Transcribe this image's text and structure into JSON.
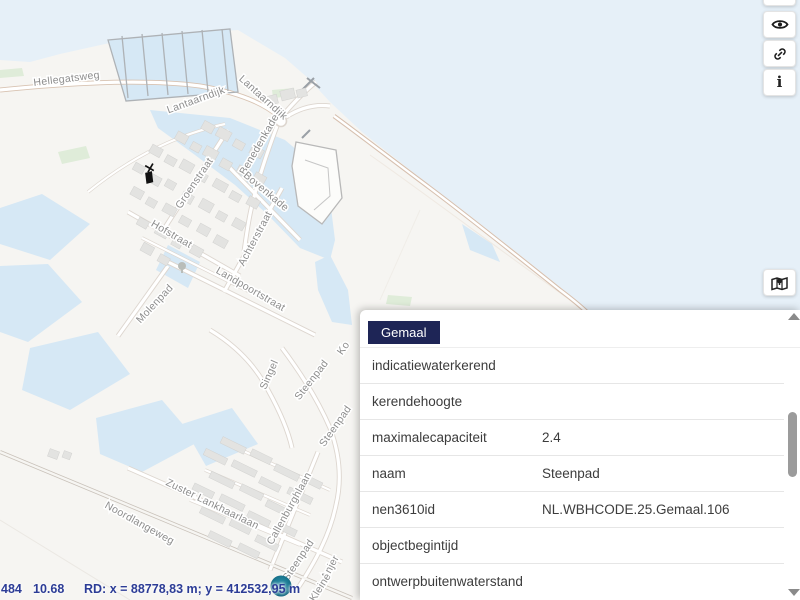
{
  "popup": {
    "tab_label": "Gemaal",
    "rows": [
      {
        "label": "indicatiewaterkerend",
        "value": ""
      },
      {
        "label": "kerendehoogte",
        "value": ""
      },
      {
        "label": "maximalecapaciteit",
        "value": "2.4"
      },
      {
        "label": "naam",
        "value": "Steenpad"
      },
      {
        "label": "nen3610id",
        "value": "NL.WBHCODE.25.Gemaal.106"
      },
      {
        "label": "objectbegintijd",
        "value": ""
      },
      {
        "label": "ontwerpbuitenwaterstand",
        "value": ""
      }
    ]
  },
  "statusbar": {
    "scale": "484",
    "level": "10.68",
    "coordinates": "RD: x = 88778,83 m; y = 412532,95 m"
  },
  "toolbar": {
    "buttons": [
      {
        "name": "visibility",
        "icon": "eye-icon"
      },
      {
        "name": "share-link",
        "icon": "link-icon"
      },
      {
        "name": "info",
        "icon": "info-icon",
        "glyph": "i"
      },
      {
        "name": "basemap",
        "icon": "map-pin-icon"
      }
    ]
  },
  "map": {
    "street_labels": [
      {
        "text": "Hellegatsweg"
      },
      {
        "text": "Lantaarndijk"
      },
      {
        "text": "Lantaarndijk"
      },
      {
        "text": "Benedenkade"
      },
      {
        "text": "Groenstraat"
      },
      {
        "text": "Bovenkade"
      },
      {
        "text": "Hofstraat"
      },
      {
        "text": "Achterstraat"
      },
      {
        "text": "Landpoortstraat"
      },
      {
        "text": "Molenpad"
      },
      {
        "text": "Singel"
      },
      {
        "text": "Steenpad"
      },
      {
        "text": "Steenpad"
      },
      {
        "text": "Ko"
      },
      {
        "text": "Zuster Lankhaarlaan"
      },
      {
        "text": "Callenburghlaan"
      },
      {
        "text": "Noordlangeweg"
      },
      {
        "text": "Steenpad"
      },
      {
        "text": "Anjer"
      },
      {
        "text": "Kleine"
      }
    ],
    "colors": {
      "sea": "#e6f0f8",
      "inner_water": "#d6e8f5",
      "tab_bg": "#1e2556",
      "status_text": "#2c3c96",
      "marker": "#1b7a94"
    }
  }
}
